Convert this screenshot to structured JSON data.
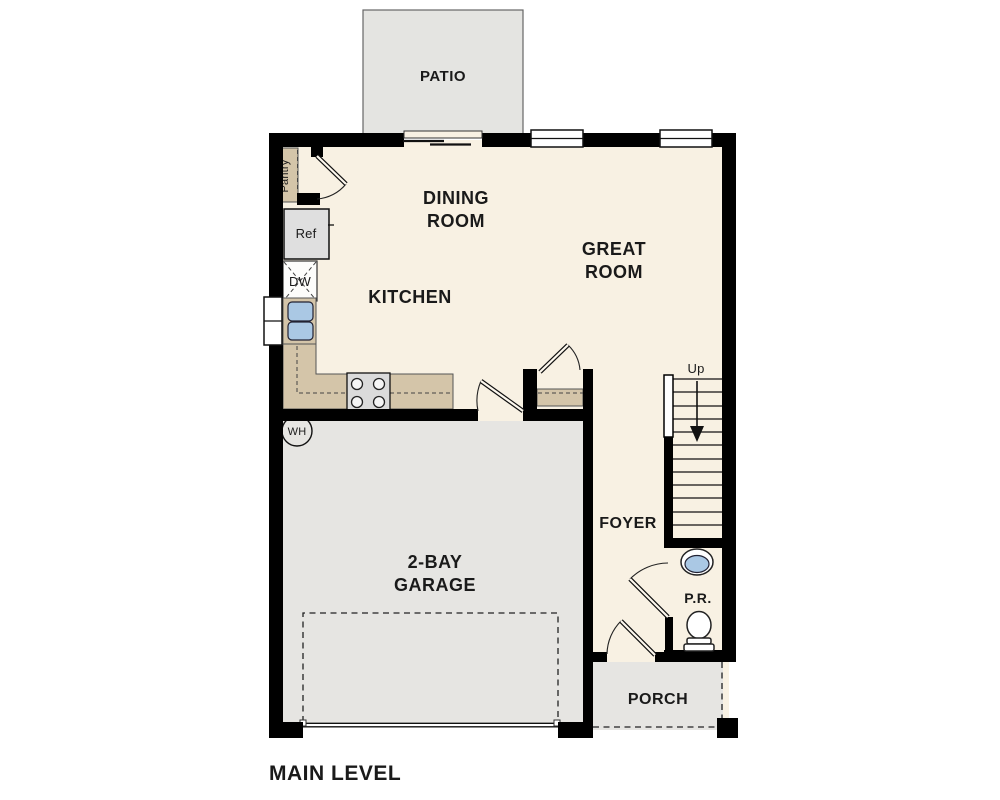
{
  "title": "MAIN LEVEL",
  "labels": {
    "patio": "PATIO",
    "dining_line1": "DINING",
    "dining_line2": "ROOM",
    "great_line1": "GREAT",
    "great_line2": "ROOM",
    "kitchen": "KITCHEN",
    "pantry": "Pantry",
    "ref": "Ref",
    "dw": "DW",
    "wh": "WH",
    "up": "Up",
    "foyer": "FOYER",
    "garage_line1": "2-BAY",
    "garage_line2": "GARAGE",
    "powder_room": "P.R.",
    "porch": "PORCH"
  },
  "colors": {
    "floor": "#f8f1e3",
    "outdoor": "#e4e4e1",
    "garage": "#e6e5e2",
    "counter": "#d4c5a9",
    "water": "#aac8e4",
    "appliance": "#dfdfdf",
    "wall": "#000000",
    "text": "#1a1a1a"
  }
}
